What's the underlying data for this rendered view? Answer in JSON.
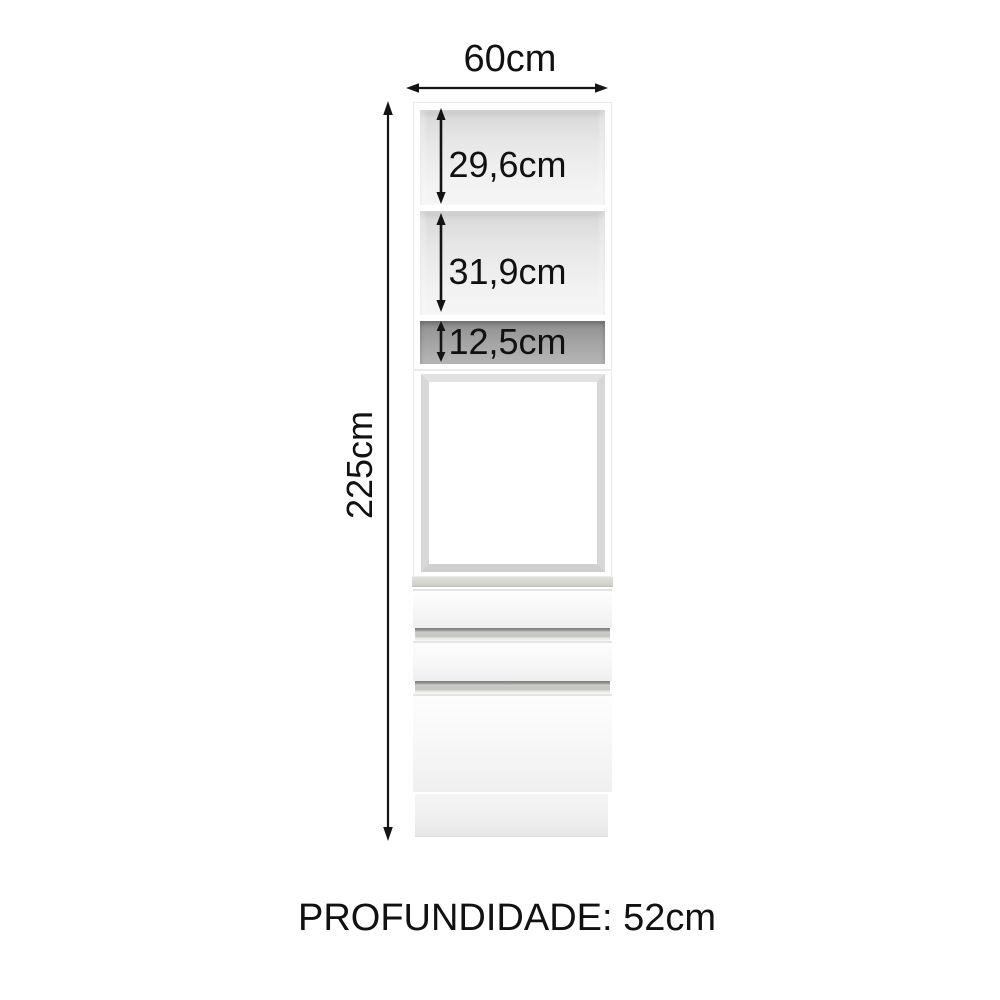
{
  "cabinet": {
    "width_label": "60cm",
    "height_label": "225cm",
    "depth_label": "PROFUNDIDADE: 52cm",
    "compartments": [
      {
        "label": "29,6cm"
      },
      {
        "label": "31,9cm"
      },
      {
        "label": "12,5cm"
      }
    ],
    "colors": {
      "text": "#111111",
      "arrow": "#141414",
      "body": "#ffffff",
      "interior_light": "#e7e7e7",
      "interior_dark": "#9c9c9c",
      "oven_frame": "#d7d7d7",
      "countertop": "#d5d5ce",
      "handle_strip": "#c5c5c0",
      "plinth": "#efefef"
    }
  }
}
